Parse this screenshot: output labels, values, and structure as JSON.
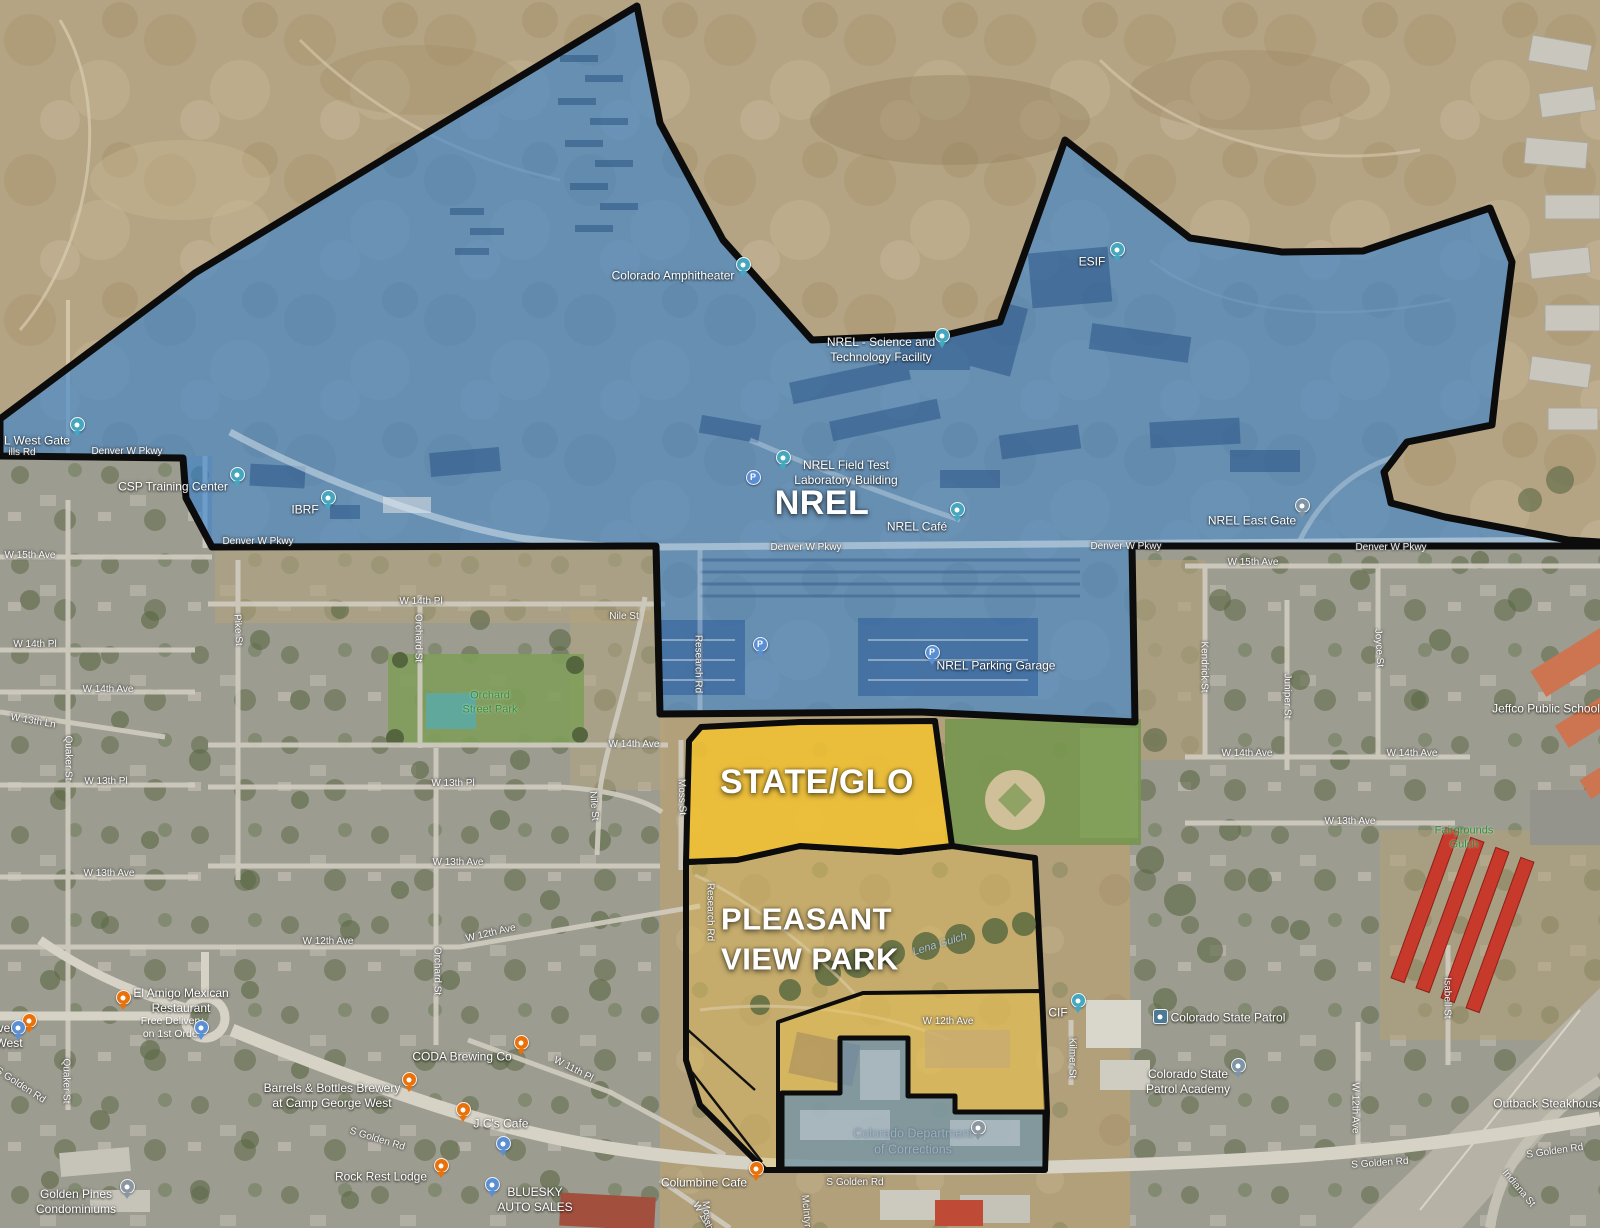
{
  "title": "NREL / STATE GLO / Pleasant View Park annotated satellite map",
  "colors": {
    "nrel_overlay": "#2d7fd4",
    "state_glo_overlay": "#f3c230",
    "park_wash": "#eec54e",
    "corrections_overlay": "#4f86c2",
    "boundary": "#0c0c0c",
    "poi_pin_teal": "#45a6bd",
    "poi_pin_orange": "#e8710a",
    "poi_pin_blue": "#5b8fd4",
    "poi_pin_gray": "#8a97a0"
  },
  "regions": [
    {
      "name": "nrel-region",
      "label_ref": "NREL"
    },
    {
      "name": "state-glo-region",
      "label_ref": "STATE/GLO"
    },
    {
      "name": "pleasant-view-park-region",
      "label_ref": "PLEASANT VIEW PARK"
    },
    {
      "name": "corrections-region",
      "label_ref": "Colorado Department of Corrections"
    }
  ],
  "labels": [
    {
      "t": "NREL",
      "x": 822,
      "y": 503,
      "c": "big",
      "n": "nrel-region-label"
    },
    {
      "t": "STATE/GLO",
      "x": 817,
      "y": 782,
      "c": "big",
      "n": "state-glo-region-label"
    },
    {
      "t": "PLEASANT\nVIEW PARK",
      "x": 810,
      "y": 940,
      "c": "big2",
      "n": "pleasant-view-park-label"
    },
    {
      "t": "W 15th Ave",
      "x": 30,
      "y": 556,
      "c": "road",
      "n": "road-w15th-ave-left"
    },
    {
      "t": "W 15th Ave",
      "x": 1253,
      "y": 563,
      "c": "road",
      "n": "road-w15th-ave-right"
    },
    {
      "t": "Denver W Pkwy",
      "x": 127,
      "y": 452,
      "c": "road",
      "n": "road-denver-w-pkwy-1"
    },
    {
      "t": "Denver W Pkwy",
      "x": 258,
      "y": 542,
      "c": "road",
      "n": "road-denver-w-pkwy-2"
    },
    {
      "t": "Denver W Pkwy",
      "x": 806,
      "y": 548,
      "c": "road",
      "n": "road-denver-w-pkwy-3"
    },
    {
      "t": "Denver W Pkwy",
      "x": 1126,
      "y": 547,
      "c": "road",
      "n": "road-denver-w-pkwy-4"
    },
    {
      "t": "Denver W Pkwy",
      "x": 1391,
      "y": 548,
      "c": "road",
      "n": "road-denver-w-pkwy-5"
    },
    {
      "t": "W 14th Pl",
      "x": 35,
      "y": 645,
      "c": "road",
      "n": "road-w14th-pl-left"
    },
    {
      "t": "W 14th Pl",
      "x": 421,
      "y": 602,
      "c": "road",
      "n": "road-w14th-pl-center"
    },
    {
      "t": "W 14th Ave",
      "x": 108,
      "y": 690,
      "c": "road",
      "n": "road-w14th-ave-left"
    },
    {
      "t": "W 14th Ave",
      "x": 634,
      "y": 745,
      "c": "road",
      "n": "road-w14th-ave-center"
    },
    {
      "t": "W 14th Ave",
      "x": 1247,
      "y": 754,
      "c": "road",
      "n": "road-w14th-ave-right1"
    },
    {
      "t": "W 14th Ave",
      "x": 1412,
      "y": 754,
      "c": "road",
      "n": "road-w14th-ave-right2"
    },
    {
      "t": "W 13th Ln",
      "x": 33,
      "y": 722,
      "r": 10,
      "c": "road",
      "n": "road-w13th-ln"
    },
    {
      "t": "W 13th Pl",
      "x": 106,
      "y": 782,
      "c": "road",
      "n": "road-w13th-pl-left"
    },
    {
      "t": "W 13th Pl",
      "x": 453,
      "y": 784,
      "c": "road",
      "n": "road-w13th-pl-center"
    },
    {
      "t": "W 13th Ave",
      "x": 109,
      "y": 874,
      "c": "road",
      "n": "road-w13th-ave-left"
    },
    {
      "t": "W 13th Ave",
      "x": 458,
      "y": 863,
      "c": "road",
      "n": "road-w13th-ave-center"
    },
    {
      "t": "W 13th Ave",
      "x": 1350,
      "y": 822,
      "c": "road",
      "n": "road-w13th-ave-right"
    },
    {
      "t": "W 12th Ave",
      "x": 328,
      "y": 942,
      "c": "road",
      "n": "road-w12th-ave-left"
    },
    {
      "t": "W 12th Ave",
      "x": 491,
      "y": 934,
      "r": -13,
      "c": "road",
      "n": "road-w12th-ave-diag"
    },
    {
      "t": "W 12th Ave",
      "x": 948,
      "y": 1022,
      "c": "road",
      "n": "road-w12th-ave-campus"
    },
    {
      "t": "W 12th Ave",
      "x": 1354,
      "y": 1108,
      "r": 90,
      "c": "road",
      "n": "road-w12th-ave-vert"
    },
    {
      "t": "W 11th Pl",
      "x": 573,
      "y": 1070,
      "r": 27,
      "c": "road",
      "n": "road-w11th-pl-1"
    },
    {
      "t": "W 11th Pl",
      "x": 705,
      "y": 1222,
      "r": 60,
      "c": "road",
      "n": "road-w11th-pl-2"
    },
    {
      "t": "Quaker St",
      "x": 67,
      "y": 758,
      "r": 90,
      "c": "road",
      "n": "road-quaker-st-1"
    },
    {
      "t": "Quaker St",
      "x": 65,
      "y": 1081,
      "r": 90,
      "c": "road",
      "n": "road-quaker-st-2"
    },
    {
      "t": "Pike St",
      "x": 237,
      "y": 630,
      "r": 87,
      "c": "road",
      "n": "road-pike-st"
    },
    {
      "t": "Orchard St",
      "x": 417,
      "y": 638,
      "r": 90,
      "c": "road",
      "n": "road-orchard-st-1"
    },
    {
      "t": "Orchard St",
      "x": 436,
      "y": 971,
      "r": 90,
      "c": "road",
      "n": "road-orchard-st-2"
    },
    {
      "t": "Nile St",
      "x": 624,
      "y": 617,
      "c": "road",
      "n": "road-nile-st-1"
    },
    {
      "t": "Nile St",
      "x": 593,
      "y": 806,
      "r": 85,
      "c": "road",
      "n": "road-nile-st-2"
    },
    {
      "t": "Moss St",
      "x": 681,
      "y": 797,
      "r": 88,
      "c": "road",
      "n": "road-moss-st"
    },
    {
      "t": "Moss St",
      "x": 706,
      "y": 1219,
      "r": 85,
      "c": "road",
      "n": "road-moss-st-2"
    },
    {
      "t": "McIntyre St",
      "x": 806,
      "y": 1220,
      "r": 85,
      "c": "road",
      "n": "road-mcintyre-st"
    },
    {
      "t": "Research Rd",
      "x": 697,
      "y": 664,
      "r": 90,
      "c": "road",
      "n": "road-research-rd-1"
    },
    {
      "t": "Research Rd",
      "x": 709,
      "y": 912,
      "r": 90,
      "c": "road",
      "n": "road-research-rd-2"
    },
    {
      "t": "Kendrick St",
      "x": 1203,
      "y": 667,
      "r": 90,
      "c": "road",
      "n": "road-kendrick-st"
    },
    {
      "t": "Juniper St",
      "x": 1286,
      "y": 696,
      "r": 90,
      "c": "road",
      "n": "road-juniper-st"
    },
    {
      "t": "Joyce St",
      "x": 1378,
      "y": 648,
      "r": 87,
      "c": "road",
      "n": "road-joyce-st"
    },
    {
      "t": "Kilmer St",
      "x": 1071,
      "y": 1058,
      "r": 90,
      "c": "road",
      "n": "road-kilmer-st"
    },
    {
      "t": "Isabell St",
      "x": 1446,
      "y": 998,
      "r": 90,
      "c": "road",
      "n": "road-isabell-st"
    },
    {
      "t": "Indiana St",
      "x": 1518,
      "y": 1189,
      "r": 50,
      "c": "road",
      "n": "road-indiana-st"
    },
    {
      "t": "S Golden Rd",
      "x": 377,
      "y": 1140,
      "r": 17,
      "c": "road",
      "n": "road-s-golden-rd-1"
    },
    {
      "t": "S Golden Rd",
      "x": 855,
      "y": 1183,
      "c": "road",
      "n": "road-s-golden-rd-2"
    },
    {
      "t": "S Golden Rd",
      "x": 1380,
      "y": 1164,
      "r": -4,
      "c": "road",
      "n": "road-s-golden-rd-3"
    },
    {
      "t": "S Golden Rd",
      "x": 1555,
      "y": 1152,
      "r": -8,
      "c": "road",
      "n": "road-s-golden-rd-4"
    },
    {
      "t": "S Golden Rd",
      "x": 20,
      "y": 1086,
      "r": 33,
      "c": "road",
      "n": "road-s-golden-rd-5"
    },
    {
      "t": "ills Rd",
      "x": 22,
      "y": 453,
      "c": "road",
      "n": "road-hills-rd-fragment"
    },
    {
      "t": "Colorado Amphitheater",
      "x": 673,
      "y": 276,
      "c": "poi",
      "n": "poi-colorado-amphitheater"
    },
    {
      "t": "NREL - Science and\nTechnology Facility",
      "x": 881,
      "y": 350,
      "c": "poi",
      "n": "poi-nrel-science-tech"
    },
    {
      "t": "NREL Field Test\nLaboratory Building",
      "x": 846,
      "y": 473,
      "c": "poi",
      "n": "poi-nrel-field-test-lab"
    },
    {
      "t": "NREL Café",
      "x": 917,
      "y": 527,
      "c": "poi",
      "n": "poi-nrel-cafe"
    },
    {
      "t": "NREL Parking Garage",
      "x": 996,
      "y": 666,
      "c": "poi",
      "n": "poi-nrel-parking-garage"
    },
    {
      "t": "ESIF",
      "x": 1092,
      "y": 262,
      "c": "poi",
      "n": "poi-esif"
    },
    {
      "t": "IBRF",
      "x": 305,
      "y": 510,
      "c": "poi",
      "n": "poi-ibrf"
    },
    {
      "t": "CSP Training Center",
      "x": 173,
      "y": 487,
      "c": "poi",
      "n": "poi-csp-training-center"
    },
    {
      "t": "NREL East Gate",
      "x": 1252,
      "y": 521,
      "c": "poi",
      "n": "poi-nrel-east-gate"
    },
    {
      "t": "L West Gate",
      "x": 37,
      "y": 441,
      "c": "poi",
      "n": "poi-nrel-west-gate"
    },
    {
      "t": "CIF",
      "x": 1058,
      "y": 1013,
      "c": "poi",
      "n": "poi-cif"
    },
    {
      "t": "Colorado State Patrol",
      "x": 1228,
      "y": 1018,
      "c": "poi",
      "n": "poi-colorado-state-patrol"
    },
    {
      "t": "Colorado State\nPatrol Academy",
      "x": 1188,
      "y": 1082,
      "c": "poi",
      "n": "poi-state-patrol-academy"
    },
    {
      "t": "Jeffco Public Schools",
      "x": 1549,
      "y": 709,
      "c": "poi",
      "n": "poi-jeffco-public-schools"
    },
    {
      "t": "Outback Steakhouse",
      "x": 1549,
      "y": 1104,
      "c": "poi",
      "n": "poi-outback-steakhouse"
    },
    {
      "t": "El Amigo Mexican\nRestaurant",
      "x": 181,
      "y": 1001,
      "c": "poi",
      "n": "poi-el-amigo"
    },
    {
      "t": "Free Delivery\non 1st Order",
      "x": 172,
      "y": 1028,
      "c": "poi-sub",
      "n": "poi-el-amigo-promo"
    },
    {
      "t": "CODA Brewing Co",
      "x": 462,
      "y": 1057,
      "c": "poi",
      "n": "poi-coda-brewing"
    },
    {
      "t": "J C's Cafe",
      "x": 501,
      "y": 1124,
      "c": "poi",
      "n": "poi-jcs-cafe"
    },
    {
      "t": "BLUESKY\nAUTO SALES",
      "x": 535,
      "y": 1200,
      "c": "poi",
      "n": "poi-bluesky-auto-sales"
    },
    {
      "t": "Rock Rest Lodge",
      "x": 381,
      "y": 1177,
      "c": "poi",
      "n": "poi-rock-rest-lodge"
    },
    {
      "t": "Barrels & Bottles Brewery\nat Camp George West",
      "x": 332,
      "y": 1096,
      "c": "poi",
      "n": "poi-barrels-bottles"
    },
    {
      "t": "very\nWest",
      "x": 9,
      "y": 1036,
      "c": "poi",
      "n": "poi-brewery-edge-fragment"
    },
    {
      "t": "Golden Pines\nCondominiums",
      "x": 76,
      "y": 1202,
      "c": "poi",
      "n": "poi-golden-pines"
    },
    {
      "t": "Columbine Cafe",
      "x": 704,
      "y": 1183,
      "c": "poi",
      "n": "poi-columbine-cafe"
    },
    {
      "t": "Colorado Department\nof Corrections",
      "x": 913,
      "y": 1142,
      "c": "corr",
      "n": "poi-dept-of-corrections"
    },
    {
      "t": "Orchard\nStreet Park",
      "x": 490,
      "y": 703,
      "c": "park",
      "n": "park-orchard-street-park"
    },
    {
      "t": "Fairgrounds\nGulch",
      "x": 1464,
      "y": 838,
      "c": "park",
      "n": "park-fairgrounds-gulch"
    },
    {
      "t": "Lena Gulch",
      "x": 940,
      "y": 945,
      "r": -17,
      "c": "water",
      "n": "water-lena-gulch"
    }
  ],
  "pins": [
    {
      "x": 743,
      "y": 277,
      "c": "#45a6bd",
      "n": "amphitheater-pin"
    },
    {
      "x": 942,
      "y": 348,
      "c": "#45a6bd",
      "n": "science-tech-facility-pin"
    },
    {
      "x": 783,
      "y": 470,
      "c": "#45a6bd",
      "n": "field-test-lab-pin"
    },
    {
      "x": 957,
      "y": 522,
      "c": "#45a6bd",
      "n": "nrel-cafe-pin"
    },
    {
      "x": 1117,
      "y": 262,
      "c": "#45a6bd",
      "n": "esif-pin"
    },
    {
      "x": 328,
      "y": 510,
      "c": "#45a6bd",
      "n": "ibrf-pin"
    },
    {
      "x": 237,
      "y": 487,
      "c": "#45a6bd",
      "n": "csp-training-center-pin"
    },
    {
      "x": 1302,
      "y": 518,
      "c": "#7e95a5",
      "n": "east-gate-icon"
    },
    {
      "x": 77,
      "y": 437,
      "c": "#45a6bd",
      "n": "west-gate-pin"
    },
    {
      "x": 1078,
      "y": 1013,
      "c": "#45a6bd",
      "n": "cif-pin"
    },
    {
      "x": 1160,
      "y": 1017,
      "c": "#4c7a94",
      "t": "badge",
      "n": "state-patrol-badge-icon"
    },
    {
      "x": 1238,
      "y": 1078,
      "c": "#7e95a5",
      "n": "patrol-academy-pin"
    },
    {
      "x": 978,
      "y": 1140,
      "c": "#8a97a0",
      "n": "corrections-pin"
    },
    {
      "x": 127,
      "y": 1199,
      "c": "#8a97a0",
      "n": "golden-pines-pin"
    },
    {
      "x": 753,
      "y": 477,
      "c": "#5b8fd4",
      "g": "P",
      "t": "circ",
      "n": "parking-icon-1"
    },
    {
      "x": 760,
      "y": 657,
      "c": "#5b8fd4",
      "g": "P",
      "n": "parking-pin-2"
    },
    {
      "x": 932,
      "y": 665,
      "c": "#5b8fd4",
      "g": "P",
      "n": "parking-garage-pin"
    },
    {
      "x": 123,
      "y": 1010,
      "c": "#e8710a",
      "n": "el-amigo-restaurant-pin"
    },
    {
      "x": 521,
      "y": 1055,
      "c": "#e8710a",
      "n": "coda-brewing-pin"
    },
    {
      "x": 463,
      "y": 1122,
      "c": "#e8710a",
      "n": "jcs-cafe-pin"
    },
    {
      "x": 756,
      "y": 1181,
      "c": "#e8710a",
      "n": "columbine-cafe-pin"
    },
    {
      "x": 441,
      "y": 1178,
      "c": "#e8710a",
      "n": "rock-rest-lodge-pin"
    },
    {
      "x": 409,
      "y": 1092,
      "c": "#e8710a",
      "n": "barrels-bottles-pin"
    },
    {
      "x": 29,
      "y": 1033,
      "c": "#e8710a",
      "n": "brewery-edge-pin"
    },
    {
      "x": 492,
      "y": 1197,
      "c": "#5b8fd4",
      "n": "bluesky-auto-pin"
    },
    {
      "x": 201,
      "y": 1040,
      "c": "#5b8fd4",
      "n": "shopping-pin-1"
    },
    {
      "x": 503,
      "y": 1156,
      "c": "#5b8fd4",
      "n": "shopping-pin-2"
    },
    {
      "x": 18,
      "y": 1040,
      "c": "#5b8fd4",
      "n": "lodging-pin-edge"
    }
  ]
}
